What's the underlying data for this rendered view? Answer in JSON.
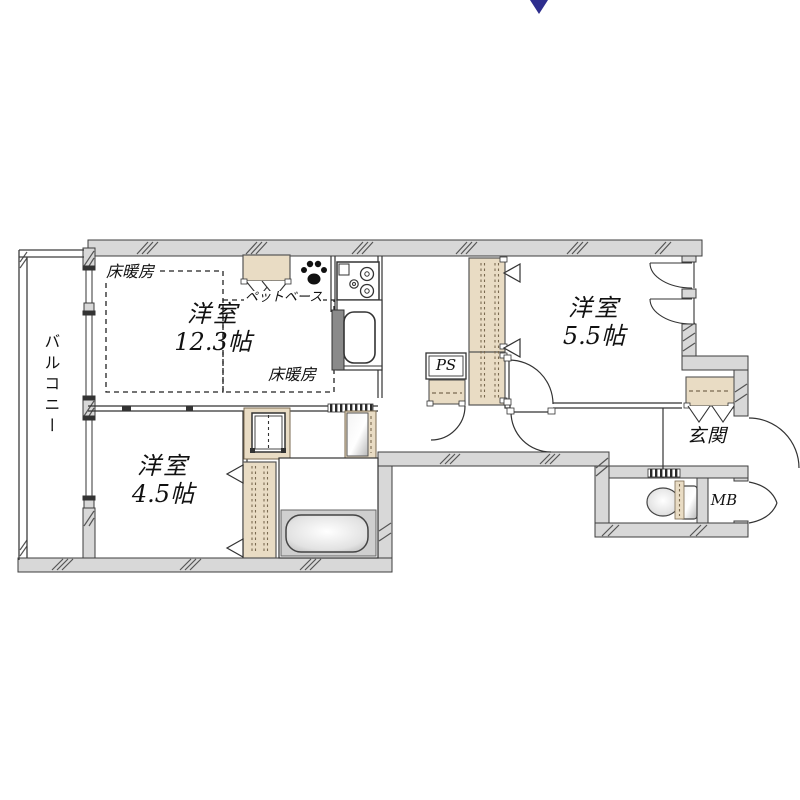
{
  "plan": {
    "balcony_label": "バルコニー",
    "rooms": {
      "living": {
        "name": "洋室",
        "size": "12.3帖"
      },
      "bedroom2": {
        "name": "洋室",
        "size": "5.5帖"
      },
      "bedroom3": {
        "name": "洋室",
        "size": "4.5帖"
      }
    },
    "entrance_label": "玄関",
    "floor_heating_label": "床暖房",
    "pet_base_label": "ペットベース",
    "ps_label": "PS",
    "mb_label": "MB"
  },
  "colors": {
    "wall": "#d8d8d8",
    "cabinet": "#e9dcc4",
    "compass": "#2e2e8e",
    "line": "#3d3d3d"
  }
}
